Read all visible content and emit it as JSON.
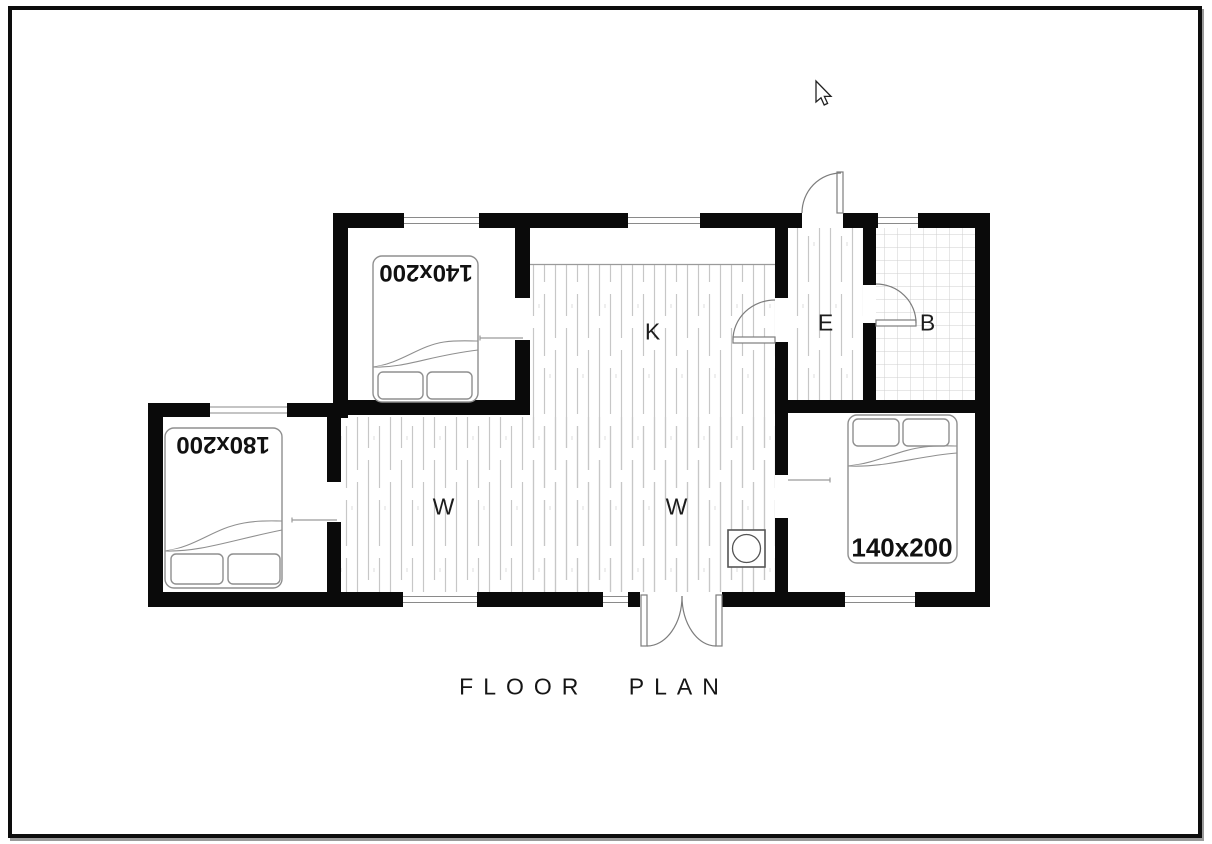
{
  "title": "FLOOR PLAN",
  "rooms": {
    "kitchen": "K",
    "entry": "E",
    "bathroom": "B",
    "living_left": "W",
    "living_right": "W"
  },
  "beds": {
    "top_bedroom": "140x200",
    "left_bedroom": "180x200",
    "right_bedroom": "140x200"
  },
  "icons": {
    "stove": "stove-icon (circle in square)",
    "cursor": "mouse-arrow-pointer"
  },
  "colors": {
    "wall": "#0a0a0a",
    "background": "#ffffff",
    "plank_line": "#c7c7c7",
    "tile_line": "#cfcfcf",
    "door_line": "#7d7d7d",
    "bed_outline": "#8f8f8f",
    "counter_line": "#9a9a9a",
    "text": "#1c1c1c"
  }
}
